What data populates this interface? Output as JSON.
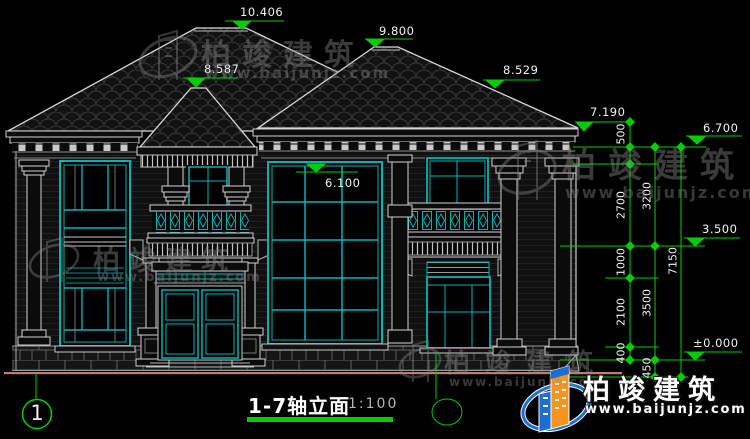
{
  "drawing": {
    "title": "1-7轴立面",
    "scale": "1:100",
    "axis_label": "1"
  },
  "levels": {
    "v10406": "10.406",
    "v9800": "9.800",
    "v8587": "8.587",
    "v8529": "8.529",
    "v7190": "7.190",
    "v6700": "6.700",
    "v6100": "6.100",
    "v3500": "3.500",
    "v0000": "±0.000"
  },
  "dims": {
    "d500": "500",
    "d2700": "2700",
    "d1000": "1000",
    "d2100": "2100",
    "d400": "400",
    "d3200": "3200",
    "d3500": "3500",
    "d450": "450",
    "d7150": "7150"
  },
  "watermark": {
    "brand": "柏竣建筑",
    "url": "www.baijunjz.com"
  },
  "logo": {
    "brand": "柏竣建筑",
    "url": "www.baijunjz.com"
  },
  "colors": {
    "line": "#d9d9d9",
    "glazing": "#00b4b4",
    "dimension": "#00cc00",
    "ground": "#c87878",
    "logo_blue": "#1a6fd4",
    "logo_orange": "#f7941d"
  }
}
